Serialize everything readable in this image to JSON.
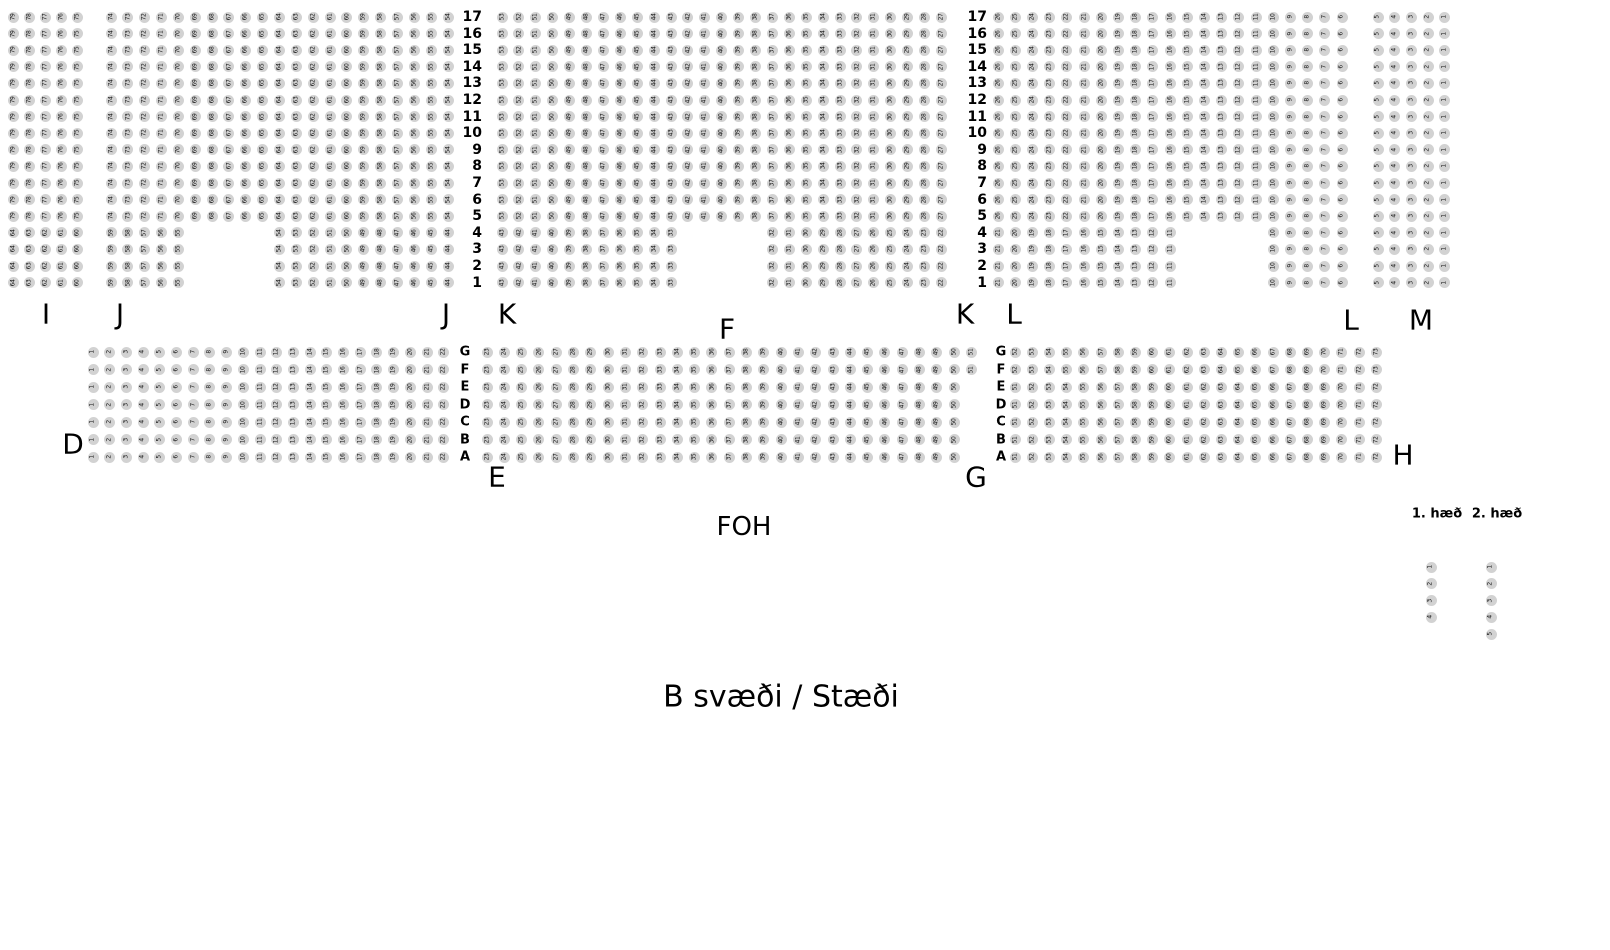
{
  "page": {
    "background": "#ffffff",
    "width": 1610,
    "height": 950
  },
  "seat_style": {
    "fill": "#d2d2d2",
    "text_color": "#111111",
    "diameter": 11
  },
  "labels": {
    "foh": {
      "text": "FOH",
      "x": 744,
      "y": 527
    },
    "area_note": {
      "text": "B svæði / Stæði",
      "x": 781,
      "y": 697
    },
    "floor_labels": [
      {
        "text": "1. hæð",
        "x": 1437,
        "y": 514
      },
      {
        "text": "2. hæð",
        "x": 1497,
        "y": 514
      }
    ],
    "section_letters": [
      {
        "text": "I",
        "x": 46,
        "y": 314
      },
      {
        "text": "J",
        "x": 120,
        "y": 314
      },
      {
        "text": "J",
        "x": 446,
        "y": 314
      },
      {
        "text": "K",
        "x": 507,
        "y": 314
      },
      {
        "text": "F",
        "x": 727,
        "y": 329
      },
      {
        "text": "K",
        "x": 965,
        "y": 314
      },
      {
        "text": "L",
        "x": 1014,
        "y": 314
      },
      {
        "text": "L",
        "x": 1351,
        "y": 320
      },
      {
        "text": "M",
        "x": 1421,
        "y": 320
      },
      {
        "text": "D",
        "x": 73,
        "y": 444
      },
      {
        "text": "E",
        "x": 497,
        "y": 477
      },
      {
        "text": "G",
        "x": 976,
        "y": 477
      },
      {
        "text": "H",
        "x": 1403,
        "y": 455
      }
    ]
  },
  "row_numbers": {
    "values": [
      "17",
      "16",
      "15",
      "14",
      "13",
      "12",
      "11",
      "10",
      "9",
      "8",
      "7",
      "6",
      "5",
      "4",
      "3",
      "2",
      "1"
    ],
    "columns_x": [
      476,
      981
    ],
    "y_start": 17,
    "dy": 16.6
  },
  "row_letters": {
    "values": [
      "G",
      "F",
      "E",
      "D",
      "C",
      "B",
      "A"
    ],
    "columns_x": [
      465,
      1001
    ],
    "y_start": 352,
    "dy": 17.5
  },
  "seat_groups": [
    {
      "section": "I",
      "x": 13,
      "y": 17,
      "dx": 16,
      "dy": 16.6,
      "cols": 5,
      "rows": 13,
      "start": 79,
      "dir": -1,
      "by": "col"
    },
    {
      "section": "I",
      "x": 13,
      "y": 232.8,
      "dx": 16,
      "dy": 16.6,
      "cols": 5,
      "rows": 4,
      "start": 64,
      "dir": -1,
      "by": "col"
    },
    {
      "section": "J",
      "x": 111,
      "y": 17,
      "dx": 16.85,
      "dy": 16.6,
      "cols": 21,
      "rows": 13,
      "start": 74,
      "dir": -1,
      "by": "col"
    },
    {
      "section": "J",
      "x": 111,
      "y": 232.8,
      "dx": 16.85,
      "dy": 16.6,
      "cols": 5,
      "rows": 4,
      "start": 59,
      "dir": -1,
      "by": "col"
    },
    {
      "section": "J",
      "x": 279.5,
      "y": 232.8,
      "dx": 16.85,
      "dy": 16.6,
      "cols": 11,
      "rows": 4,
      "start": 54,
      "dir": -1,
      "by": "col"
    },
    {
      "section": "K",
      "x": 502,
      "y": 17,
      "dx": 16.9,
      "dy": 16.6,
      "cols": 27,
      "rows": 13,
      "start": 53,
      "dir": -1,
      "by": "col"
    },
    {
      "section": "K",
      "x": 502,
      "y": 232.8,
      "dx": 16.9,
      "dy": 16.6,
      "cols": 11,
      "rows": 4,
      "start": 43,
      "dir": -1,
      "by": "col"
    },
    {
      "section": "K",
      "x": 772.4,
      "y": 232.8,
      "dx": 16.9,
      "dy": 16.6,
      "cols": 11,
      "rows": 4,
      "start": 32,
      "dir": -1,
      "by": "col"
    },
    {
      "section": "L",
      "x": 998,
      "y": 17,
      "dx": 17.2,
      "dy": 16.6,
      "cols": 21,
      "rows": 13,
      "start": 26,
      "dir": -1,
      "by": "col"
    },
    {
      "section": "L",
      "x": 998,
      "y": 232.8,
      "dx": 17.2,
      "dy": 16.6,
      "cols": 11,
      "rows": 4,
      "start": 21,
      "dir": -1,
      "by": "col"
    },
    {
      "section": "L",
      "x": 1273.2,
      "y": 232.8,
      "dx": 17.2,
      "dy": 16.6,
      "cols": 5,
      "rows": 4,
      "start": 10,
      "dir": -1,
      "by": "col"
    },
    {
      "section": "M",
      "x": 1378,
      "y": 17,
      "dx": 16.7,
      "dy": 16.6,
      "cols": 5,
      "rows": 17,
      "start": 5,
      "dir": -1,
      "by": "col"
    },
    {
      "section": "D",
      "x": 93,
      "y": 352,
      "dx": 16.7,
      "dy": 17.5,
      "cols": 22,
      "rows": 7,
      "start": 1,
      "dir": 1,
      "by": "col"
    },
    {
      "section": "E",
      "x": 487,
      "y": 352,
      "dx": 17.3,
      "dy": 17.5,
      "cols": 29,
      "rows": 2,
      "start": 23,
      "dir": 1,
      "by": "col"
    },
    {
      "section": "E",
      "x": 487,
      "y": 387,
      "dx": 17.3,
      "dy": 17.5,
      "cols": 28,
      "rows": 5,
      "start": 23,
      "dir": 1,
      "by": "col"
    },
    {
      "section": "G",
      "x": 1015,
      "y": 352,
      "dx": 17.2,
      "dy": 17.5,
      "cols": 22,
      "rows": 2,
      "start": 52,
      "dir": 1,
      "by": "col"
    },
    {
      "section": "G",
      "x": 1015,
      "y": 387,
      "dx": 17.2,
      "dy": 17.5,
      "cols": 22,
      "rows": 5,
      "start": 51,
      "dir": 1,
      "by": "col"
    },
    {
      "section": "1. hæð",
      "x": 1431,
      "y": 567,
      "dx": 0,
      "dy": 16.8,
      "cols": 1,
      "rows": 4,
      "start": 1,
      "dir": 1,
      "by": "row"
    },
    {
      "section": "2. hæð",
      "x": 1491,
      "y": 567,
      "dx": 0,
      "dy": 16.8,
      "cols": 1,
      "rows": 5,
      "start": 1,
      "dir": 1,
      "by": "row"
    }
  ]
}
